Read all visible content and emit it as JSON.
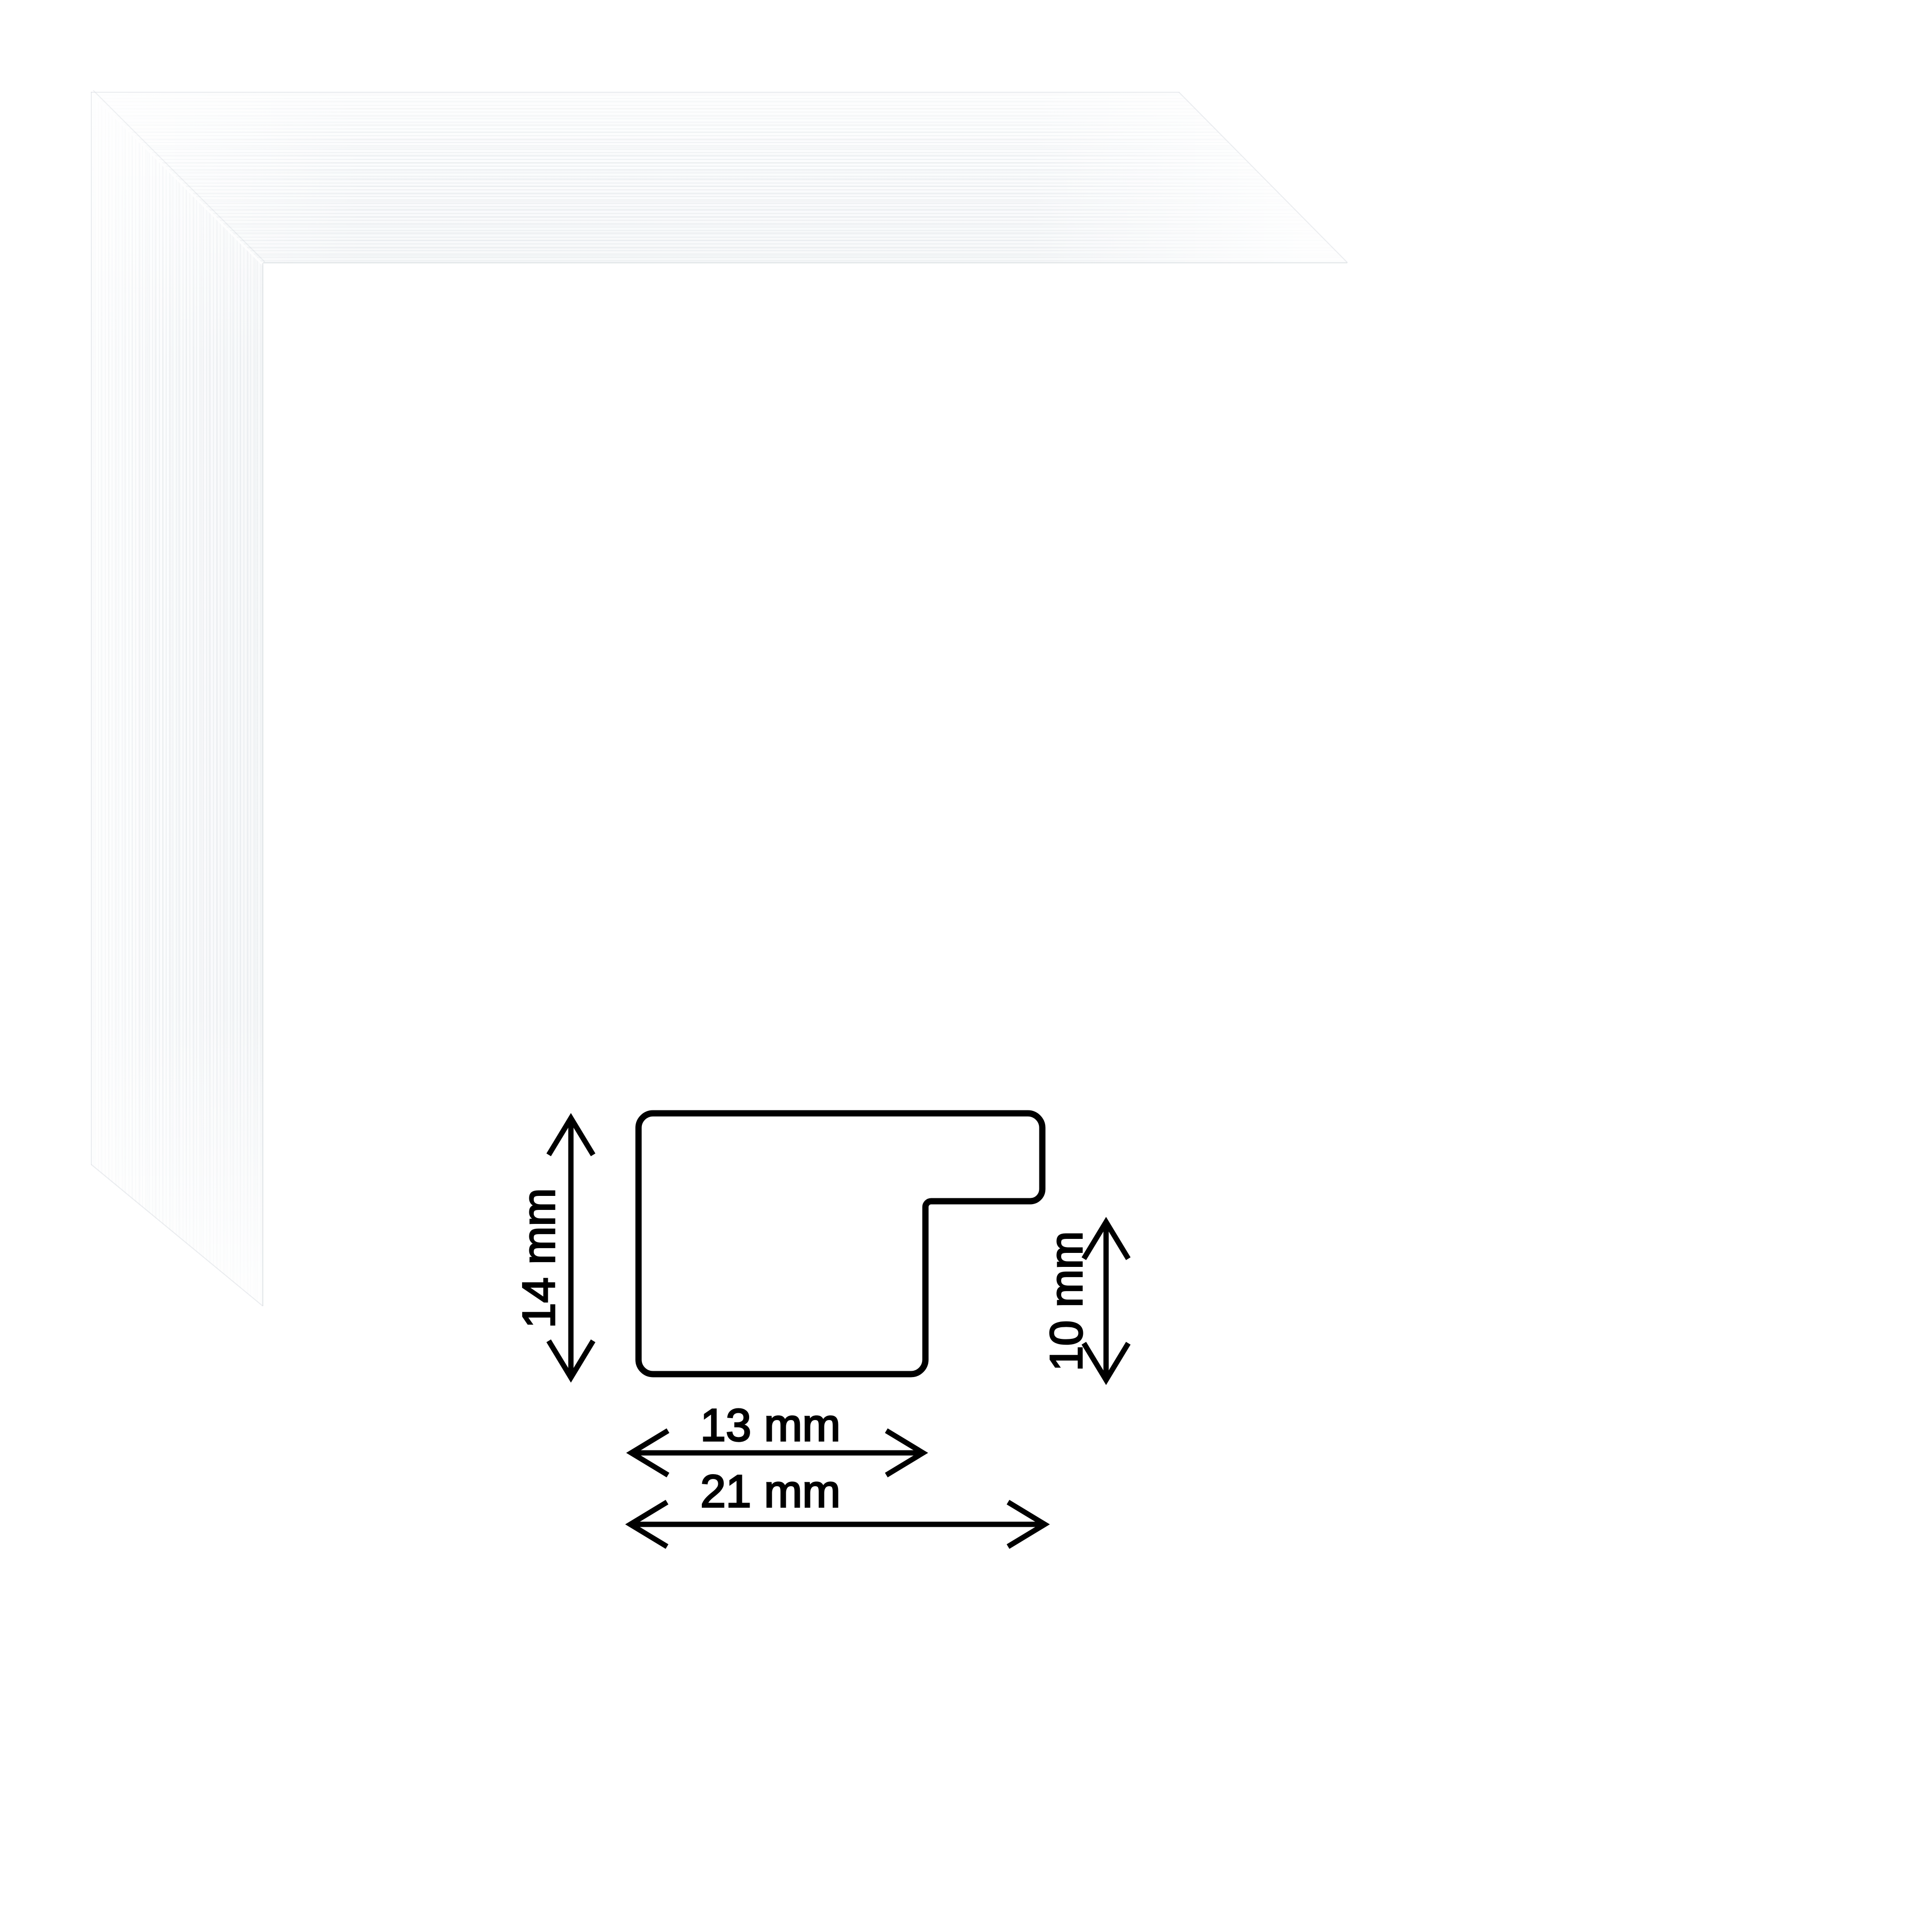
{
  "image": {
    "kind": "picture-frame moulding product image with cross-section dimension diagram",
    "background_color": "#ffffff"
  },
  "frame_sample": {
    "description": "white frame corner sample, mitered ends, subtle brushed wood grain",
    "face_color": "#fbfcfd",
    "grain_color": "#e2e6e9"
  },
  "diagram": {
    "line_color": "#000000",
    "text_color": "#000000",
    "dimensions": {
      "height": {
        "label": "14 mm",
        "value": 14,
        "unit": "mm"
      },
      "rabbet_depth": {
        "label": "10 mm",
        "value": 10,
        "unit": "mm"
      },
      "face_width": {
        "label": "13 mm",
        "value": 13,
        "unit": "mm"
      },
      "total_width": {
        "label": "21 mm",
        "value": 21,
        "unit": "mm"
      }
    }
  }
}
